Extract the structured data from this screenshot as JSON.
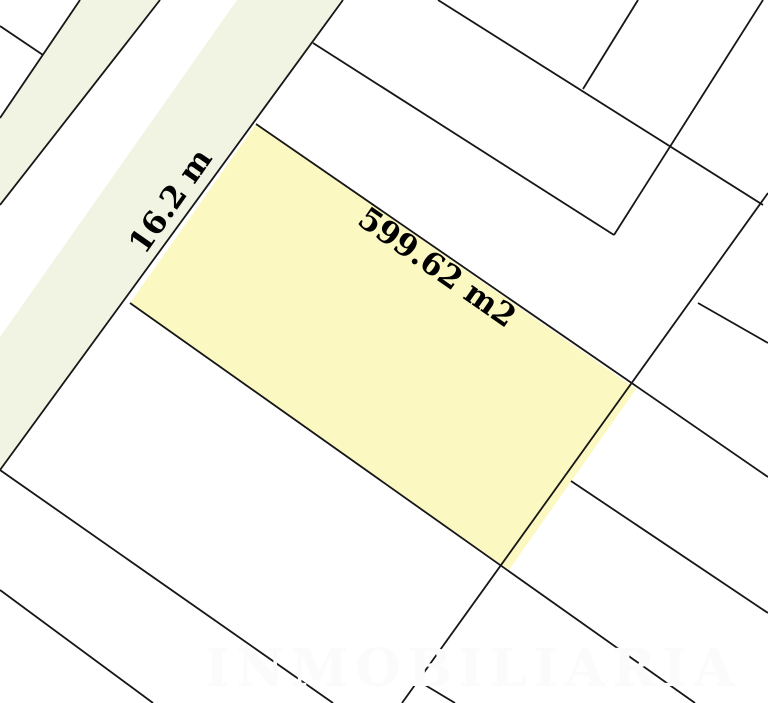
{
  "map": {
    "title": "cadastral parcel map",
    "background": "#ffffff",
    "line_color": "#161616",
    "road": {
      "fill": "#f1f4e2"
    },
    "parcel": {
      "fill": "#fbf9c1",
      "area_label": "599.62 m2",
      "area_value_m2": 599.62,
      "frontage_label": "16.2 m",
      "frontage_value_m": 16.2
    },
    "watermark": {
      "text": "INMOBILIARIA",
      "color": "#fbfbfb"
    }
  }
}
